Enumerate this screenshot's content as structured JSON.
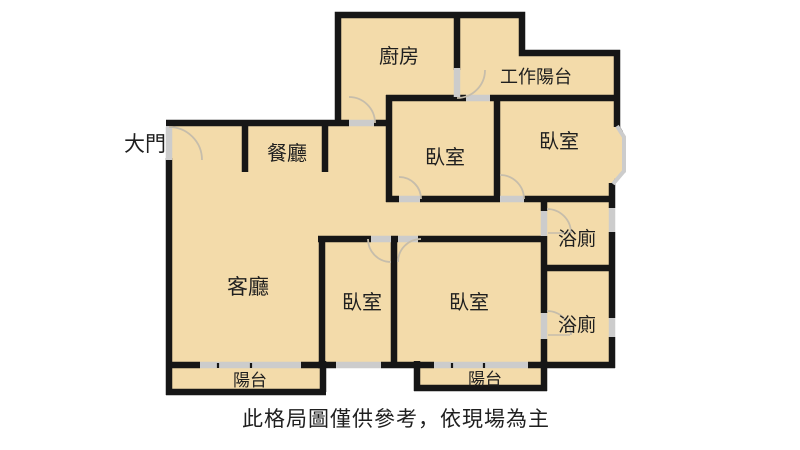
{
  "colors": {
    "floor": "#f3dbaa",
    "wall": "#161616",
    "opening": "#cccccc",
    "text": "#1f1f1f"
  },
  "labels": {
    "entrance": "大門",
    "kitchen": "廚房",
    "work_balcony": "工作陽台",
    "dining": "餐廳",
    "bedroom_top_mid": "臥室",
    "bedroom_top_right": "臥室",
    "bath_upper": "浴廁",
    "living": "客廳",
    "bedroom_bottom_left": "臥室",
    "bedroom_master": "臥室",
    "bath_lower": "浴廁",
    "balcony_living": "陽台",
    "balcony_master": "陽台",
    "caption": "此格局圖僅供參考，依現場為主"
  }
}
